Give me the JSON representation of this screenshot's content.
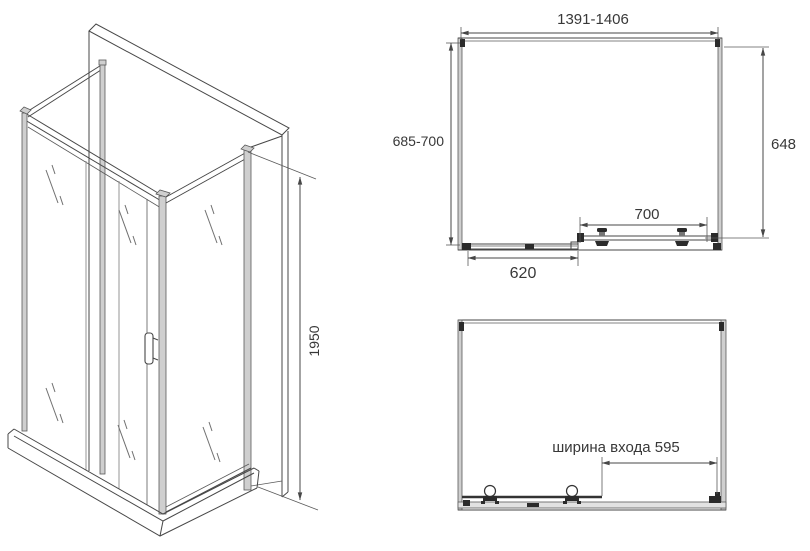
{
  "drawing": {
    "title_semantic": "shower-enclosure-technical-drawing",
    "dimensions": {
      "width_range": "1391-1406",
      "depth_range": "685-700",
      "depth_inner": "648",
      "door_panel": "700",
      "fixed_panel": "620",
      "height": "1950",
      "entry_width_label": "ширина входа 595"
    },
    "colors": {
      "line": "#474747",
      "text": "#383838",
      "profile_fill": "#cfcfcf",
      "hardware_dark": "#2b2b2b",
      "background": "#ffffff"
    }
  }
}
